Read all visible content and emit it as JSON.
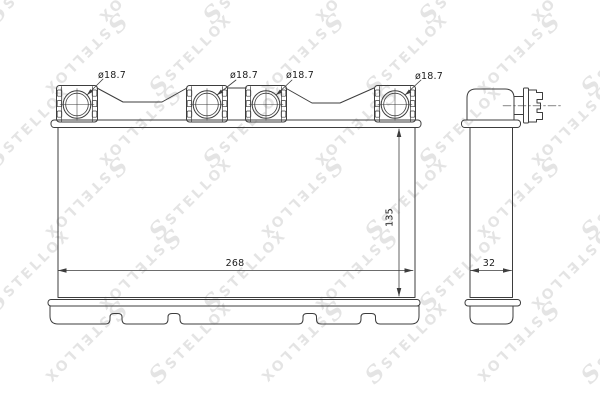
{
  "watermark": {
    "initial": "S",
    "brand": "STELLOX"
  },
  "drawing": {
    "front_view": {
      "port_labels": [
        "ø18.7",
        "ø18.7",
        "ø18.7",
        "ø18.7"
      ],
      "width_dim": "268",
      "height_dim": "135"
    },
    "side_view": {
      "depth_dim": "32"
    }
  },
  "colors": {
    "background": "#ffffff",
    "line": "#3d3d3d",
    "detail_line": "#4a4a4a",
    "label_text": "#1c1c1c",
    "watermark": "#cfcfcf"
  }
}
